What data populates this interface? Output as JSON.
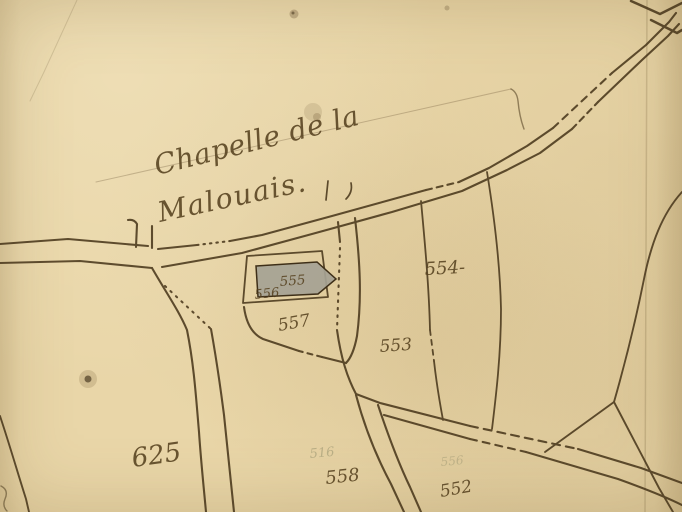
{
  "map_title": {
    "line1": "Chapelle de la",
    "line2": "Malouais."
  },
  "parcels": {
    "labels": [
      {
        "name": "554",
        "text": "554-"
      },
      {
        "name": "553",
        "text": "553"
      },
      {
        "name": "555",
        "text": "555"
      },
      {
        "name": "556",
        "text": "556"
      },
      {
        "name": "557",
        "text": "557"
      },
      {
        "name": "558",
        "text": "558"
      },
      {
        "name": "552",
        "text": "552"
      },
      {
        "name": "625",
        "text": "625"
      }
    ],
    "ghost_labels": [
      {
        "text": "516"
      },
      {
        "text": "556"
      }
    ]
  },
  "features": {
    "chapel_building": {
      "label": "555",
      "type": "hatched-building"
    },
    "roads": [
      "main-road-northeast",
      "west-road",
      "south-road-from-junction",
      "chapel-lane",
      "bottom-road-southeast"
    ]
  },
  "colors": {
    "paper": "#e9d6a8",
    "ink": "#4a381c",
    "handwriting": "#55411f",
    "building_fill": "#a5a294",
    "ghost_ink": "#8e8c68"
  }
}
